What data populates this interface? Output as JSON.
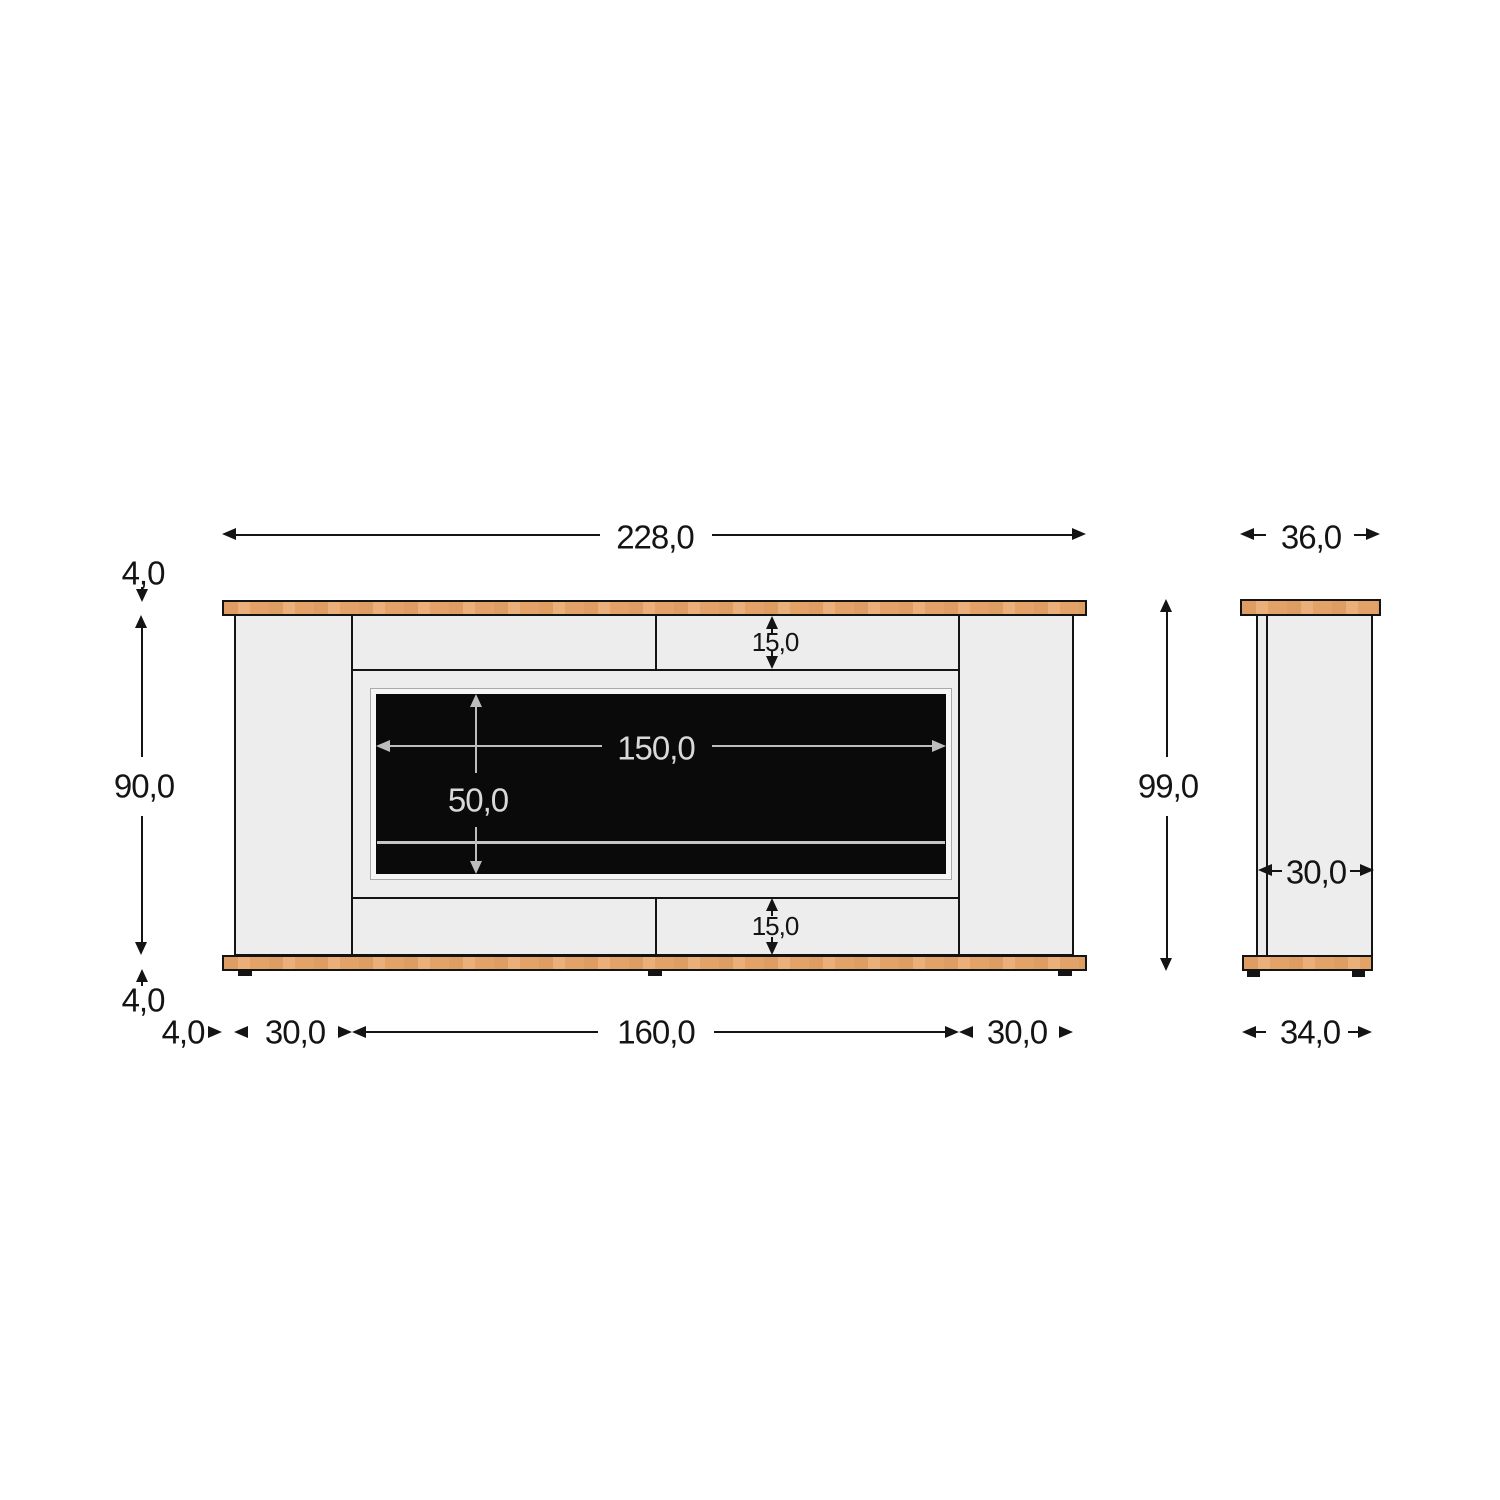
{
  "drawing": {
    "type": "furniture-dimension-drawing",
    "views": {
      "front": {
        "overall_width": "228,0",
        "top_panel_thickness": "4,0",
        "body_height": "90,0",
        "bottom_panel_thickness": "4,0",
        "top_rail_height": "15,0",
        "opening_width": "150,0",
        "opening_height": "50,0",
        "bottom_rail_height": "15,0",
        "base_overhang": "4,0",
        "left_pillar_width": "30,0",
        "center_width": "160,0",
        "right_pillar_width": "30,0"
      },
      "side": {
        "top_width": "36,0",
        "overall_height": "99,0",
        "body_depth": "30,0",
        "bottom_width": "34,0"
      }
    },
    "colors": {
      "wood": "#e9a86c",
      "panel": "#ededed",
      "firebox": "#0a0a0a",
      "outline": "#141414",
      "dim_gray": "#bdbdbd",
      "dim_text_light": "#d9d9d9",
      "background": "#ffffff"
    }
  }
}
